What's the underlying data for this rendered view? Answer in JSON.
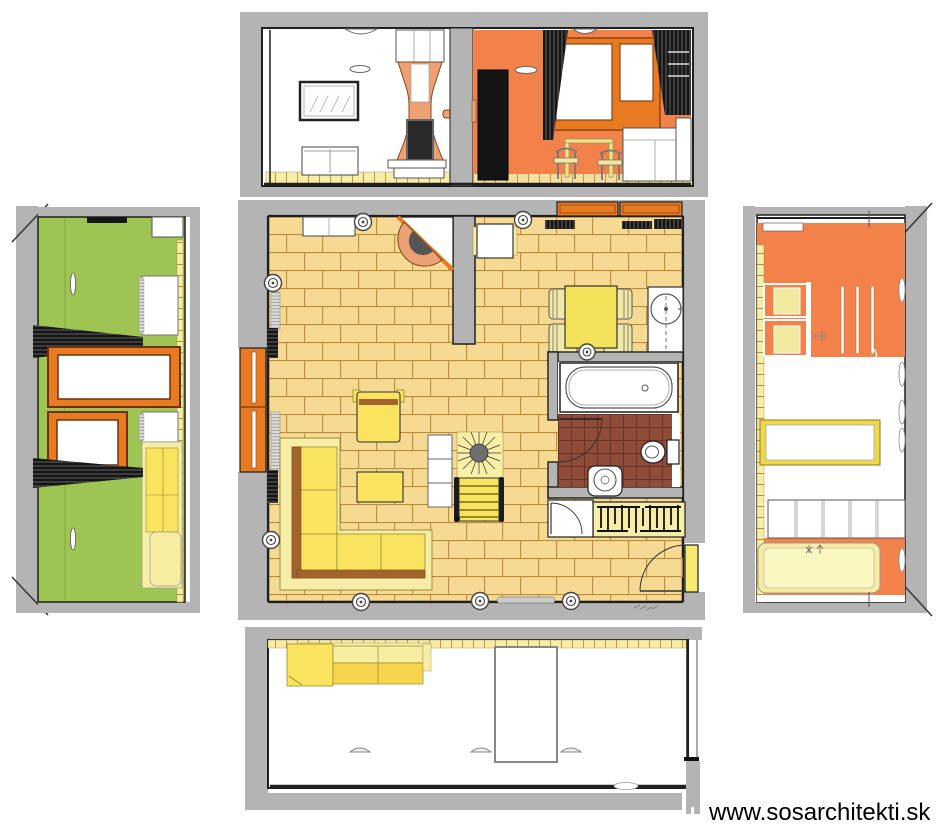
{
  "watermark": {
    "text": "www.sosarchitekti.sk"
  },
  "colors": {
    "background": "#ffffff",
    "wall_gray": "#b4b4b4",
    "outline": "#1f1f1f",
    "floor_tan": "#f6d992",
    "floor_line": "#bb8c3c",
    "bath_floor": "#8e4c39",
    "bath_line": "#6a3325",
    "accent_orange": "#f2814a",
    "frame_orange": "#e87a22",
    "wall_green": "#9ec454",
    "furniture_yellow": "#f9e35f",
    "pale_yellow": "#f6eda6",
    "deep_yellow": "#f6d44e",
    "sofa_brown": "#a2642c",
    "stove_copper": "#eda072",
    "firebox_gray": "#555555",
    "curtain_black": "#161616",
    "radiator_gray": "#dedede",
    "white": "#ffffff",
    "watermark_black": "#000000"
  },
  "views": {
    "plan": {
      "name": "floor-plan",
      "rooms": [
        "living-room",
        "kitchen-dining",
        "bathroom",
        "entry-hall"
      ],
      "furniture": [
        "corner-sofa",
        "armchair",
        "coffee-table",
        "shelf-unit",
        "plant",
        "deck-chair",
        "corner-fireplace",
        "sideboard",
        "kitchen-table",
        "dining-table",
        "dining-chairs",
        "washing-machine",
        "bathtub",
        "toilet",
        "washbasin",
        "wardrobe",
        "closet",
        "entry-door"
      ]
    },
    "top": {
      "name": "north-wall-elevation",
      "items": [
        "picture-frame",
        "sideboard",
        "tile-stove",
        "fridge",
        "window",
        "curtains",
        "dining-table",
        "chairs",
        "kitchen-cabinet"
      ]
    },
    "left": {
      "name": "west-wall-elevation",
      "items": [
        "green-wall-panels",
        "windows",
        "curtains",
        "radiators",
        "sofa-side"
      ]
    },
    "right": {
      "name": "east-wall-elevation",
      "items": [
        "orange-wall",
        "dining-chairs-side",
        "mirror",
        "cabinet-row",
        "bench"
      ]
    },
    "bottom": {
      "name": "south-wall-elevation",
      "items": [
        "sofa-back",
        "door-panel",
        "wall-lamps"
      ]
    }
  }
}
